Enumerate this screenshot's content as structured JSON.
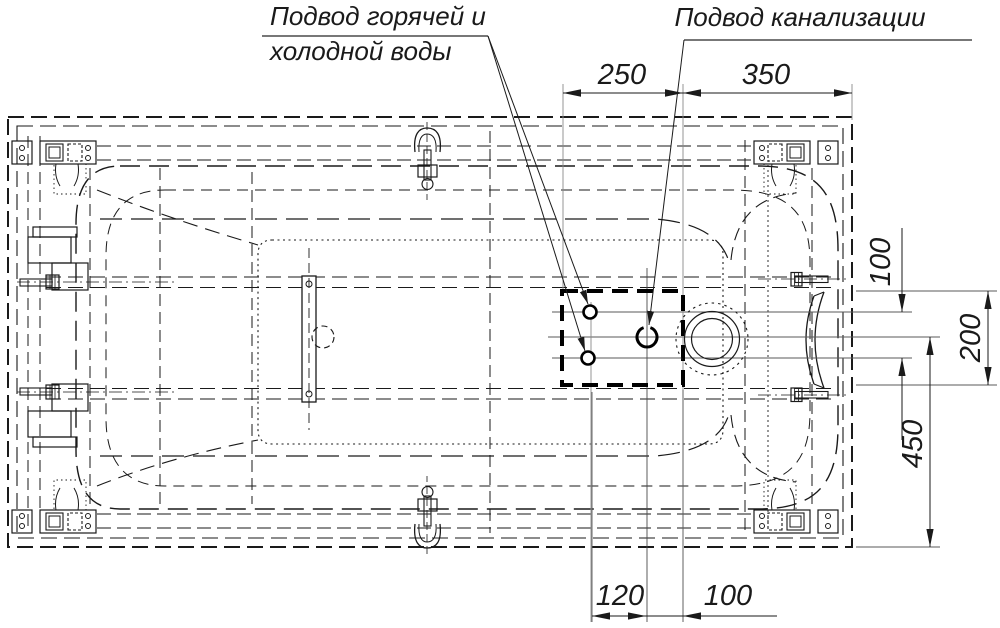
{
  "labels": {
    "water_line1": "Подвод горячей и",
    "water_line2": "холодной воды",
    "sewage": "Подвод канализации"
  },
  "dims": {
    "d250": "250",
    "d350": "350",
    "r100": "100",
    "r200": "200",
    "r450": "450",
    "b120": "120",
    "b100": "100"
  },
  "colors": {
    "line": "#1a1a1a",
    "thin_line": "#5a5a5a",
    "background": "#ffffff"
  }
}
